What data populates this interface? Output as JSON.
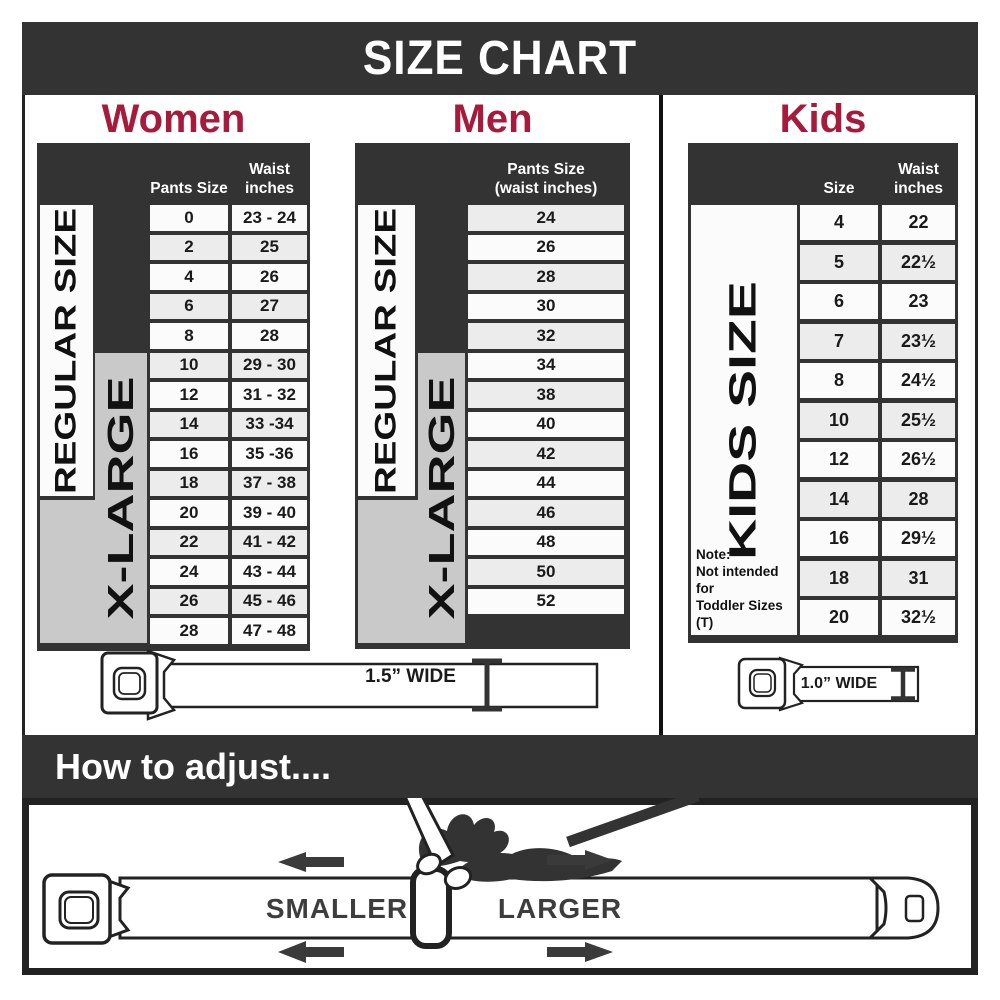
{
  "banner": {
    "title": "SIZE CHART"
  },
  "colors": {
    "accent": "#A61B3C",
    "panel_dark": "#333333",
    "row_light": "#FBFBFB",
    "row_alt": "#ECECEC",
    "xlarge_gray": "#C9C9C9"
  },
  "women": {
    "heading": "Women",
    "col1_header": "Pants Size",
    "col2_header_line1": "Waist",
    "col2_header_line2": "inches",
    "regular_label": "REGULAR SIZE",
    "xlarge_label": "X-LARGE",
    "rows": [
      [
        "0",
        "23 - 24"
      ],
      [
        "2",
        "25"
      ],
      [
        "4",
        "26"
      ],
      [
        "6",
        "27"
      ],
      [
        "8",
        "28"
      ],
      [
        "10",
        "29 - 30"
      ],
      [
        "12",
        "31 - 32"
      ],
      [
        "14",
        "33 -34"
      ],
      [
        "16",
        "35 -36"
      ],
      [
        "18",
        "37 - 38"
      ],
      [
        "20",
        "39 - 40"
      ],
      [
        "22",
        "41 - 42"
      ],
      [
        "24",
        "43 - 44"
      ],
      [
        "26",
        "45 - 46"
      ],
      [
        "28",
        "47 - 48"
      ]
    ],
    "belt_label": "1.5” WIDE"
  },
  "men": {
    "heading": "Men",
    "col_header_line1": "Pants Size",
    "col_header_line2": "(waist inches)",
    "regular_label": "REGULAR SIZE",
    "xlarge_label": "X-LARGE",
    "rows": [
      [
        "24"
      ],
      [
        "26"
      ],
      [
        "28"
      ],
      [
        "30"
      ],
      [
        "32"
      ],
      [
        "34"
      ],
      [
        "38"
      ],
      [
        "40"
      ],
      [
        "42"
      ],
      [
        "44"
      ],
      [
        "46"
      ],
      [
        "48"
      ],
      [
        "50"
      ],
      [
        "52"
      ]
    ]
  },
  "kids": {
    "heading": "Kids",
    "col1_header": "Size",
    "col2_header_line1": "Waist",
    "col2_header_line2": "inches",
    "size_label": "KIDS SIZE",
    "note_line1": "Note:",
    "note_line2": "Not intended for",
    "note_line3": "Toddler Sizes (T)",
    "rows": [
      [
        "4",
        "22"
      ],
      [
        "5",
        "22½"
      ],
      [
        "6",
        "23"
      ],
      [
        "7",
        "23½"
      ],
      [
        "8",
        "24½"
      ],
      [
        "10",
        "25½"
      ],
      [
        "12",
        "26½"
      ],
      [
        "14",
        "28"
      ],
      [
        "16",
        "29½"
      ],
      [
        "18",
        "31"
      ],
      [
        "20",
        "32½"
      ]
    ],
    "belt_label": "1.0” WIDE"
  },
  "adjust": {
    "heading": "How to adjust....",
    "smaller_label": "SMALLER",
    "larger_label": "LARGER"
  }
}
